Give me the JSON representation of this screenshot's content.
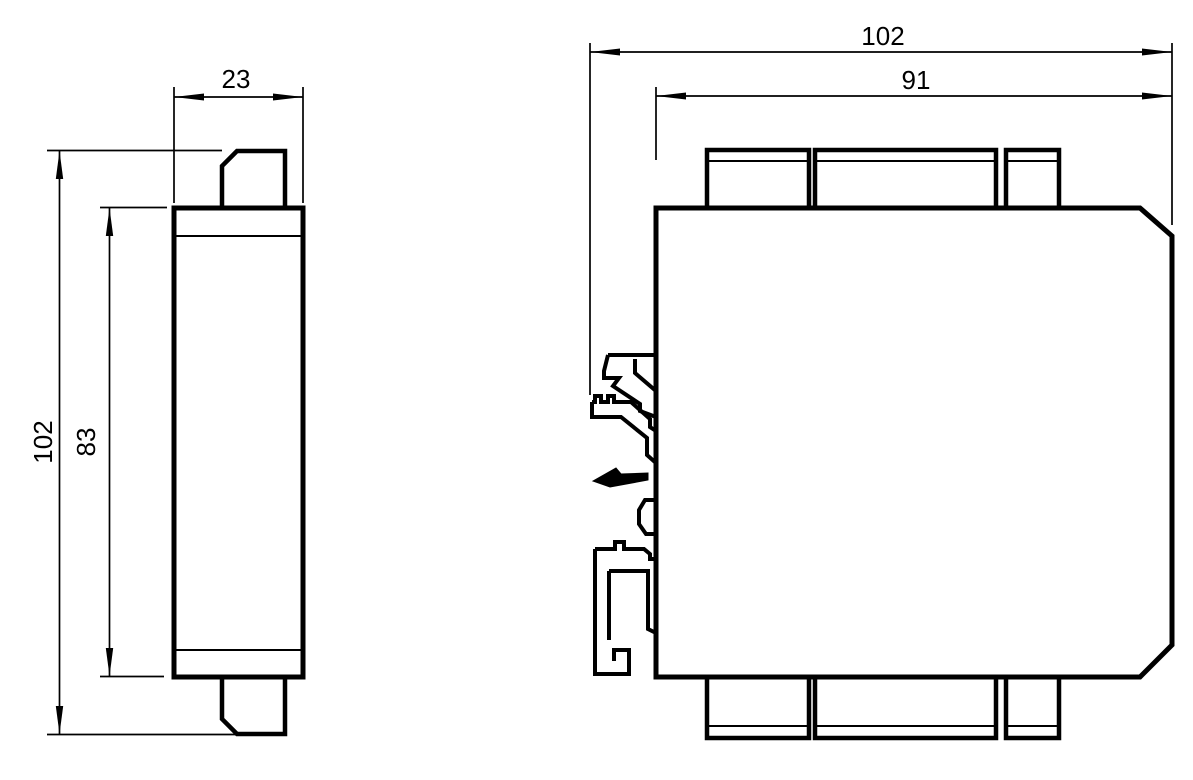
{
  "colors": {
    "line": "#000000",
    "background": "#ffffff"
  },
  "views": {
    "side_view": {
      "dimensions": {
        "width": "23",
        "overall_height": "102",
        "body_height": "83"
      }
    },
    "front_view": {
      "dimensions": {
        "overall_width": "102",
        "body_width": "91"
      }
    }
  }
}
